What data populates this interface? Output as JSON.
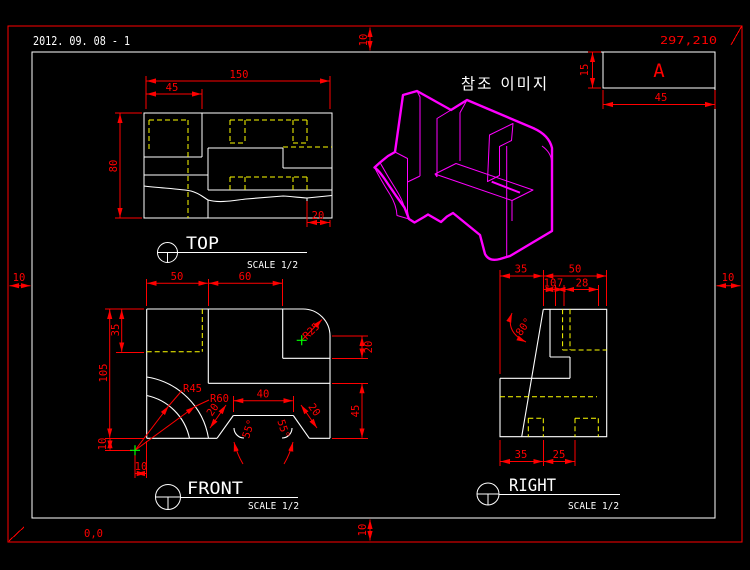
{
  "colors": {
    "background": "#000000",
    "outline": "#ffffff",
    "dimension": "#ff0000",
    "hidden_line": "#ffff00",
    "iso_model": "#ff00ff",
    "center_mark": "#00ff00"
  },
  "sheet": {
    "date_title": "2012. 09. 08 - 1",
    "top_right_coord": "297,210",
    "bottom_left_coord": "0,0",
    "margins": {
      "top": "10",
      "bottom": "10",
      "left": "10",
      "right": "10"
    },
    "revision_block": {
      "label": "A",
      "width_dim": "45",
      "height_dim": "15"
    }
  },
  "iso_view": {
    "caption": "참조 이미지"
  },
  "top_view": {
    "title": "TOP",
    "scale_label": "SCALE 1/2",
    "dims": {
      "overall_width": "150",
      "pocket_width": "45",
      "overall_depth": "80",
      "step_width": "20"
    }
  },
  "front_view": {
    "title": "FRONT",
    "scale_label": "SCALE 1/2",
    "dims": {
      "left_width": "50",
      "right_width": "60",
      "pocket_height": "35",
      "overall_height": "105",
      "corner_radius": "R25",
      "arc_radius_inner": "R45",
      "arc_radius_outer": "R60",
      "slot_top_width": "40",
      "slot_side_left": "20",
      "slot_side_right": "20",
      "slot_angle_left": "55°",
      "slot_angle_right": "55°",
      "step_height": "20",
      "lower_height": "45",
      "offset_x": "10",
      "offset_y": "10"
    }
  },
  "right_view": {
    "title": "RIGHT",
    "scale_label": "SCALE 1/2",
    "dims": {
      "top_left": "35",
      "top_right": "50",
      "sub_a": "10",
      "sub_b": "7",
      "sub_c": "28",
      "slope_angle": "80°",
      "bottom_left": "35",
      "bottom_right": "25"
    }
  }
}
